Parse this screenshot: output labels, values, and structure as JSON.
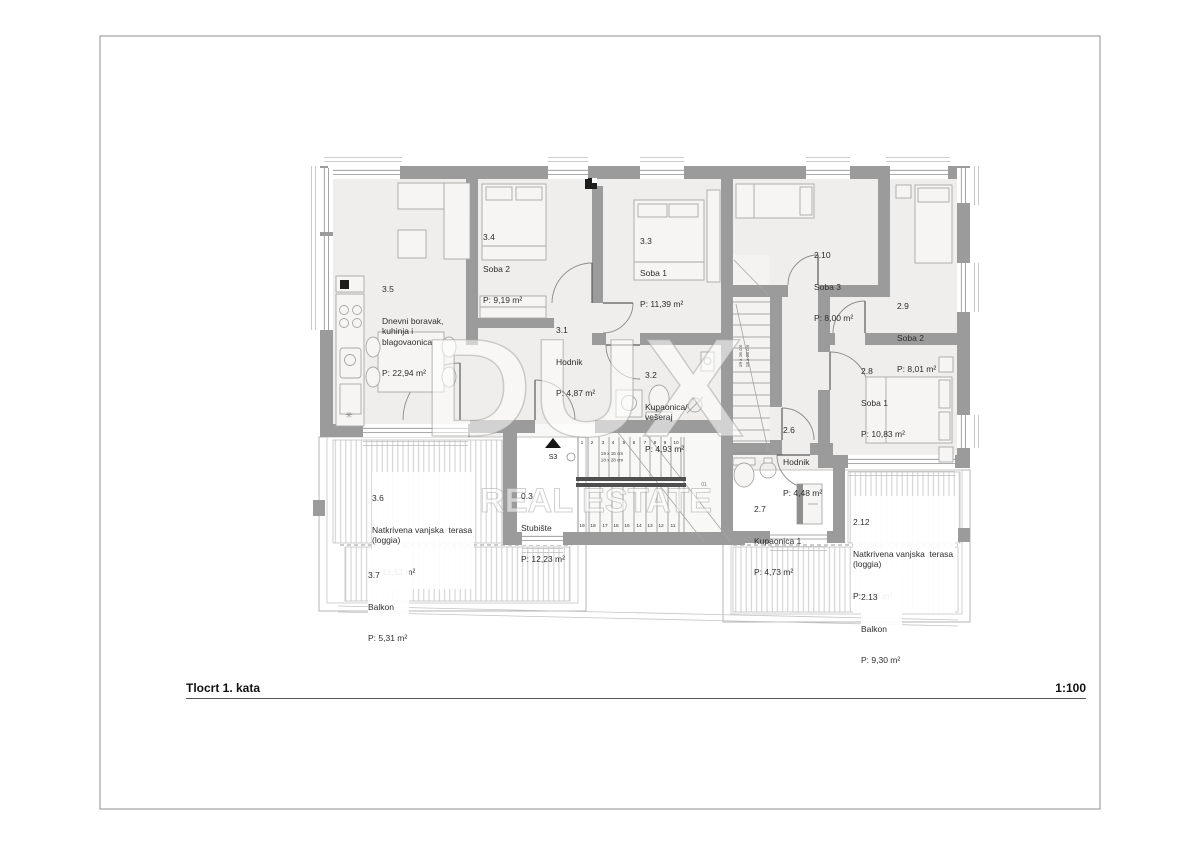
{
  "titlebar": {
    "drawing_title": "Tlocrt 1. kata",
    "scale": "1:100"
  },
  "watermark": {
    "brand": "DUX",
    "tagline": "REAL ESTATE"
  },
  "glyphs": {
    "kitchen_symbol": "✳"
  },
  "rooms": [
    {
      "id": "3.5",
      "name": "Dnevni boravak,\nkuhinja i\nblagovaonica",
      "area": "P: 22,94 m²"
    },
    {
      "id": "3.4",
      "name": "Soba 2",
      "area": "P: 9,19 m²"
    },
    {
      "id": "3.3",
      "name": "Soba 1",
      "area": "P: 11,39 m²"
    },
    {
      "id": "3.1",
      "name": "Hodnik",
      "area": "P: 4,87 m²"
    },
    {
      "id": "3.2",
      "name": "Kupaonica/\nvešeraj",
      "area": "P: 4,93 m²"
    },
    {
      "id": "0.3",
      "name": "Stubište",
      "area": "P: 12,23 m²"
    },
    {
      "id": "2.10",
      "name": "Soba 3",
      "area": "P: 8,00 m²"
    },
    {
      "id": "2.9",
      "name": "Soba 2",
      "area": "P: 8,01 m²"
    },
    {
      "id": "2.8",
      "name": "Soba 1",
      "area": "P: 10,83 m²"
    },
    {
      "id": "2.6",
      "name": "Hodnik",
      "area": "P: 4,48 m²"
    },
    {
      "id": "2.7",
      "name": "Kupaonica 1",
      "area": "P: 4,73 m²"
    },
    {
      "id": "3.6",
      "name": "Natkrivena vanjska  terasa\n(loggia)",
      "area": "P: 11,12 m²"
    },
    {
      "id": "3.7",
      "name": "Balkon",
      "area": "P: 5,31 m²"
    },
    {
      "id": "2.12",
      "name": "Natkrivena vanjska  terasa\n(loggia)",
      "area": "P: 3,37 m²"
    },
    {
      "id": "2.13",
      "name": "Balkon",
      "area": "P: 9,30 m²"
    }
  ],
  "stairs": {
    "marker": "S3",
    "dim_line1": "19 x 16 cm",
    "dim_line2": "18 x 28 cm",
    "note": "01",
    "steps_up": [
      "1",
      "2",
      "3",
      "4",
      "5",
      "6",
      "7",
      "8",
      "9",
      "10"
    ],
    "steps_down": [
      "19",
      "18",
      "17",
      "16",
      "15",
      "14",
      "13",
      "12",
      "11"
    ]
  },
  "colors": {
    "wall": "#9b9b9b",
    "floor": "#efeeec",
    "accent_dark": "#4f4f4f"
  }
}
